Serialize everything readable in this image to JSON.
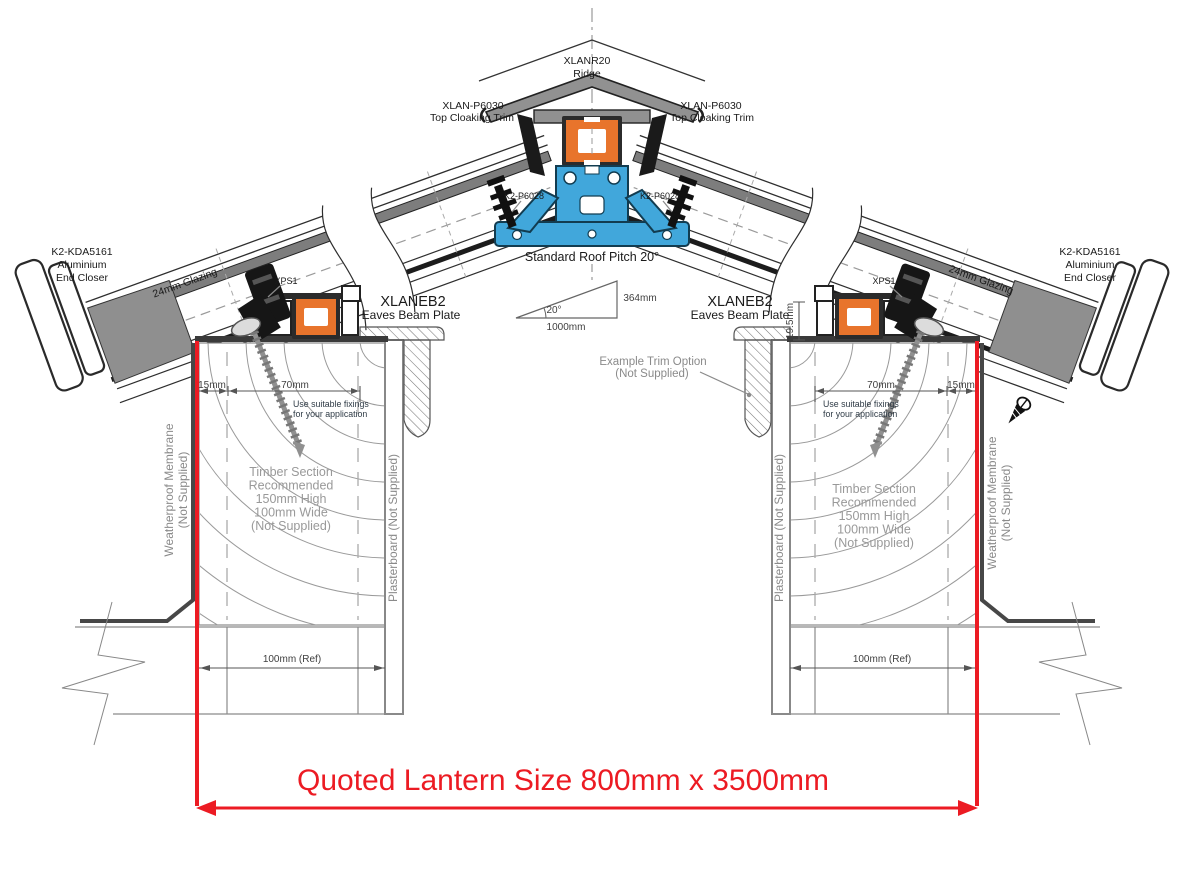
{
  "diagram": {
    "ridge": {
      "code": "XLANR20",
      "name": "Ridge"
    },
    "cloaking_left": {
      "code": "XLAN-P6030",
      "name": "Top Cloaking Trim"
    },
    "cloaking_right": {
      "code": "XLAN-P6030",
      "name": "Top Cloaking Trim"
    },
    "glazing_bar_left": "K2-P6028",
    "glazing_bar_right": "K2-P6028",
    "pitch": {
      "title": "Standard Roof Pitch 20°",
      "angle": "20°",
      "run": "1000mm",
      "rise": "364mm"
    },
    "end_closer_left": {
      "code": "K2-KDA5161",
      "l2": "Aluminium",
      "l3": "End Closer"
    },
    "end_closer_right": {
      "code": "K2-KDA5161",
      "l2": "Aluminium",
      "l3": "End Closer"
    },
    "glazing_left": "24mm Glazing",
    "glazing_right": "24mm Glazing",
    "xps_left": "XPS1",
    "xps_right": "XPS1",
    "eaves_left": {
      "code": "XLANEB2",
      "name": "Eaves Beam Plate"
    },
    "eaves_right": {
      "code": "XLANEB2",
      "name": "Eaves Beam Plate"
    },
    "trim_option": {
      "l1": "Example  Trim Option",
      "l2": "(Not Supplied)"
    },
    "fixings_left": {
      "l1": "Use suitable fixings",
      "l2": "for your application"
    },
    "fixings_right": {
      "l1": "Use suitable fixings",
      "l2": "for your application"
    },
    "timber_left": [
      "Timber Section",
      "Recommended",
      "150mm High",
      "100mm Wide",
      "(Not Supplied)"
    ],
    "timber_right": [
      "Timber Section",
      "Recommended",
      "150mm High",
      "100mm Wide",
      "(Not Supplied)"
    ],
    "membrane_left": {
      "l1": "Weatherproof Membrane",
      "l2": "(Not Supplied)"
    },
    "membrane_right": {
      "l1": "Weatherproof Membrane",
      "l2": "(Not Supplied)"
    },
    "plasterboard_left": "Plasterboard (Not Supplied)",
    "plasterboard_right": "Plasterboard (Not Supplied)",
    "dims": {
      "left_15": "15mm",
      "left_70": "70mm",
      "right_70": "70mm",
      "right_15": "15mm",
      "right_height": "19.5mm",
      "ref_left": "100mm (Ref)",
      "ref_right": "100mm (Ref)"
    },
    "quote": "Quoted Lantern Size 800mm x 3500mm",
    "colors": {
      "red": "#EC1B23",
      "orange": "#E8742C",
      "blue": "#41A7DB"
    }
  }
}
